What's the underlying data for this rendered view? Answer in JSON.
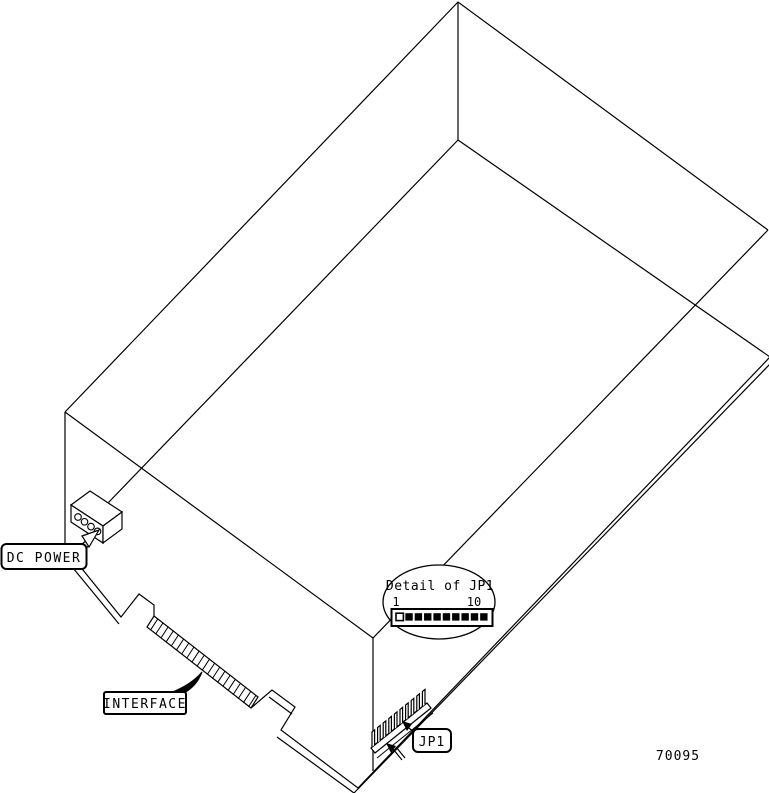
{
  "figure": {
    "number": "70095"
  },
  "labels": {
    "dc_power": "DC POWER",
    "interface": "INTERFACE",
    "jp1": "JP1"
  },
  "detail": {
    "title": "Detail of JP1",
    "pin_first_label": "1",
    "pin_last_label": "10",
    "pin_count": 10,
    "open_pin_index": 1
  },
  "components": {
    "dc_power_holes": 4,
    "interface_fingers": 20,
    "jp1_pins": 10
  },
  "colors": {
    "line": "#000000",
    "background": "#ffffff"
  }
}
